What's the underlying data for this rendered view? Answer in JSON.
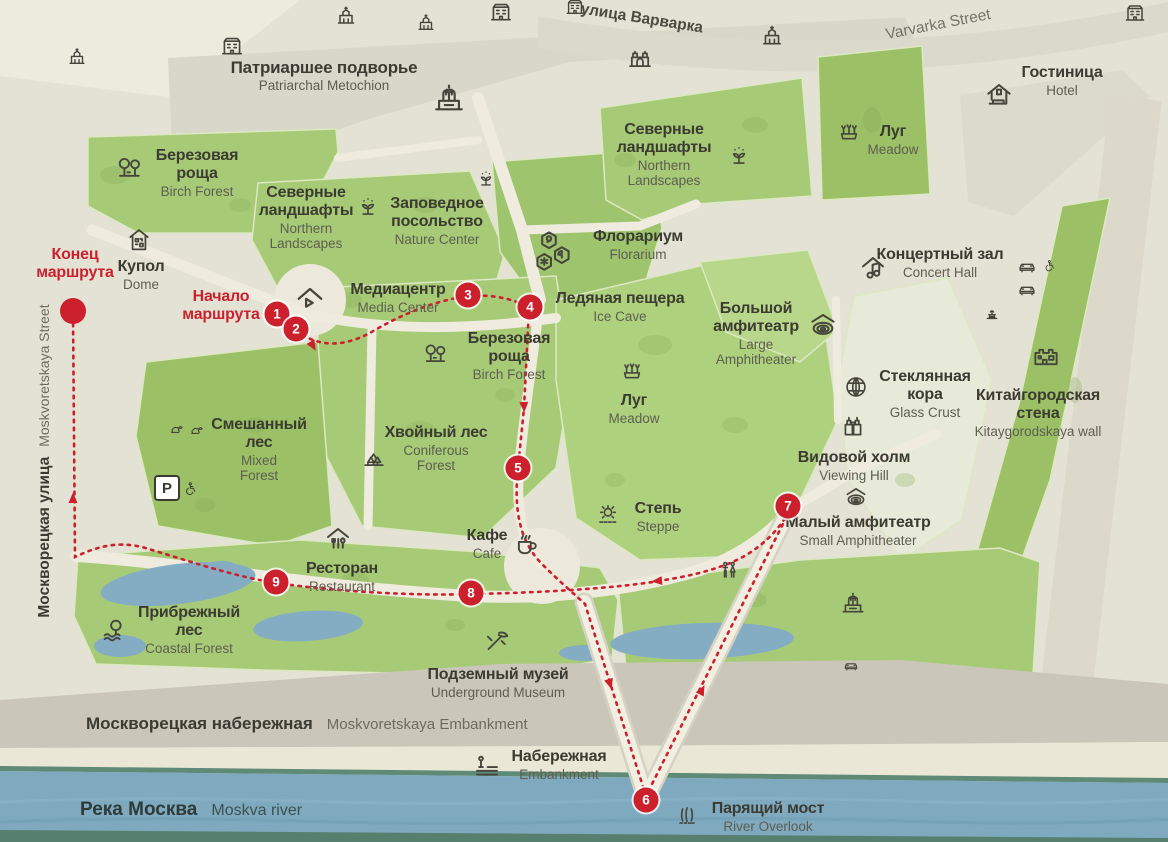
{
  "route": {
    "start_label": "Начало маршрута",
    "end_label": "Конец маршрута",
    "color": "#cc202d",
    "markers": [
      {
        "number": "1"
      },
      {
        "number": "2"
      },
      {
        "number": "3"
      },
      {
        "number": "4"
      },
      {
        "number": "5"
      },
      {
        "number": "6"
      },
      {
        "number": "7"
      },
      {
        "number": "8"
      },
      {
        "number": "9"
      }
    ]
  },
  "streets": {
    "varvarka": {
      "ru": "улица Варварка",
      "en": "Varvarka Street"
    },
    "moskvoretskaya_street": {
      "ru": "Москворецкая улица",
      "en": "Moskvoretskaya Street"
    },
    "moskvoretskaya_embankment": {
      "ru": "Москворецкая набережная",
      "en": "Moskvoretskaya Embankment"
    },
    "moskva_river": {
      "ru": "Река Москва",
      "en": "Moskva river"
    }
  },
  "pois": {
    "patriarchal_metochion": {
      "ru": "Патриаршее подворье",
      "en": "Patriarchal Metochion"
    },
    "hotel": {
      "ru": "Гостиница",
      "en": "Hotel"
    },
    "meadow_ne": {
      "ru": "Луг",
      "en": "Meadow"
    },
    "northern_landscapes_ne": {
      "ru": "Северные ландшафты",
      "en": "Northern Landscapes"
    },
    "birch_forest_nw": {
      "ru": "Березовая роща",
      "en": "Birch Forest"
    },
    "northern_landscapes_w": {
      "ru": "Северные ландшафты",
      "en": "Northern Landscapes"
    },
    "nature_center": {
      "ru": "Заповедное посольство",
      "en": "Nature Center"
    },
    "florarium": {
      "ru": "Флорариум",
      "en": "Florarium"
    },
    "dome": {
      "ru": "Купол",
      "en": "Dome"
    },
    "media_center": {
      "ru": "Медиацентр",
      "en": "Media Center"
    },
    "ice_cave": {
      "ru": "Ледяная пещера",
      "en": "Ice Cave"
    },
    "large_amphitheater": {
      "ru": "Большой амфитеатр",
      "en": "Large Amphitheater"
    },
    "concert_hall": {
      "ru": "Концертный зал",
      "en": "Concert Hall"
    },
    "birch_forest_center": {
      "ru": "Березовая роща",
      "en": "Birch Forest"
    },
    "meadow_center": {
      "ru": "Луг",
      "en": "Meadow"
    },
    "glass_crust": {
      "ru": "Стеклянная кора",
      "en": "Glass Crust"
    },
    "kitaygorodskaya_wall": {
      "ru": "Китайгородская стена",
      "en": "Kitaygorodskaya wall"
    },
    "mixed_forest": {
      "ru": "Смешанный лес",
      "en": "Mixed Forest"
    },
    "coniferous_forest": {
      "ru": "Хвойный лес",
      "en": "Coniferous Forest"
    },
    "viewing_hill": {
      "ru": "Видовой холм",
      "en": "Viewing Hill"
    },
    "small_amphitheater": {
      "ru": "Малый амфитеатр",
      "en": "Small Amphitheater"
    },
    "steppe": {
      "ru": "Степь",
      "en": "Steppe"
    },
    "cafe": {
      "ru": "Кафе",
      "en": "Cafe"
    },
    "restaurant": {
      "ru": "Ресторан",
      "en": "Restaurant"
    },
    "coastal_forest": {
      "ru": "Прибрежный лес",
      "en": "Coastal Forest"
    },
    "underground_museum": {
      "ru": "Подземный музей",
      "en": "Underground Museum"
    },
    "embankment": {
      "ru": "Набережная",
      "en": "Embankment"
    },
    "river_overlook": {
      "ru": "Парящий мост",
      "en": "River Overlook"
    }
  },
  "icons": {
    "parking_label": "P",
    "glyphs": [
      "church-icon",
      "cathedral-icon",
      "building-icon",
      "gate-icon",
      "hotel-icon",
      "birch-trees-icon",
      "pine-trees-icon",
      "meadow-flowers-icon",
      "sprout-icon",
      "nature-hexagons-icon",
      "media-play-icon",
      "dome-qr-icon",
      "concert-music-icon",
      "amphitheater-icon",
      "geodesic-sphere-icon",
      "fortress-wall-icon",
      "binoculars-icon",
      "steppe-sun-icon",
      "coffee-cup-icon",
      "restaurant-cutlery-icon",
      "tree-water-icon",
      "museum-pickaxe-icon",
      "embankment-lamp-icon",
      "bridge-reeds-icon",
      "wc-icon",
      "fountain-icon",
      "car-icon",
      "wheelchair-icon",
      "wildlife-icon",
      "parking-icon"
    ]
  },
  "colors": {
    "background": "#e4e2d4",
    "park_green": "#a7ca77",
    "park_green_dark": "#9bc066",
    "park_green_bright": "#b9d78a",
    "pale_area": "#e7ead9",
    "path": "#efecdf",
    "embankment_band": "#cac7ba",
    "river": "#7ea9bf",
    "river_edge": "#5e8a76",
    "pond": "#84adc3",
    "route_red": "#cc202d",
    "text_dark": "#3b3b32",
    "text_muted": "#5e5e50"
  }
}
